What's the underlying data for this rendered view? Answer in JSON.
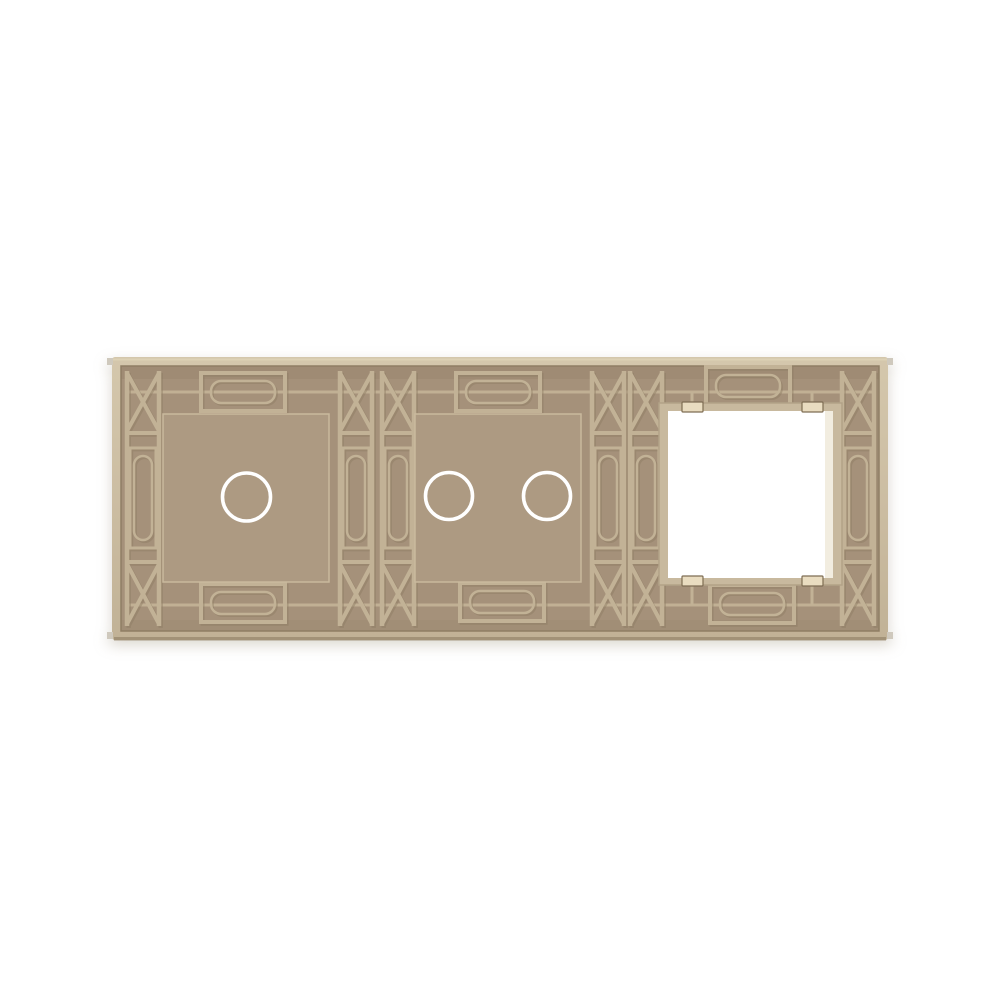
{
  "page": {
    "background": "#ffffff"
  },
  "panel": {
    "kind": "triple-gang wall panel, rear view",
    "sections": [
      {
        "id": "switch-1gang",
        "type": "touch-switch",
        "circles": 1
      },
      {
        "id": "switch-2gang",
        "type": "touch-switch",
        "circles": 2
      },
      {
        "id": "module-frame",
        "type": "socket-frame-opening",
        "circles": 0,
        "clips": 4
      }
    ],
    "colors": {
      "page_bg": "#ffffff",
      "rim_top": "#d4c7ac",
      "rim_mid": "#cbbca1",
      "rim_bottom": "#c1b296",
      "rim_edge": "#8f7e64",
      "recess": "#a5917a",
      "recess_deep": "#9c8970",
      "recess_shade": "#8f7d63",
      "rib": "#c2b296",
      "rib_shadow": "#8d7c63",
      "plateau": "#ad9a82",
      "plateau_edge": "#c9b99d",
      "ring": "#ffffff",
      "opening_frame": "#c8b99e",
      "opening_frame_edge": "#b2a287",
      "opening": "#ffffff",
      "opening_shade": "#efe8d8",
      "clip_face": "#e9dcc0",
      "clip_edge": "#7e6d53",
      "under_shadow": "#9a8a6f",
      "mold_tab": "#cfc9bd"
    }
  }
}
